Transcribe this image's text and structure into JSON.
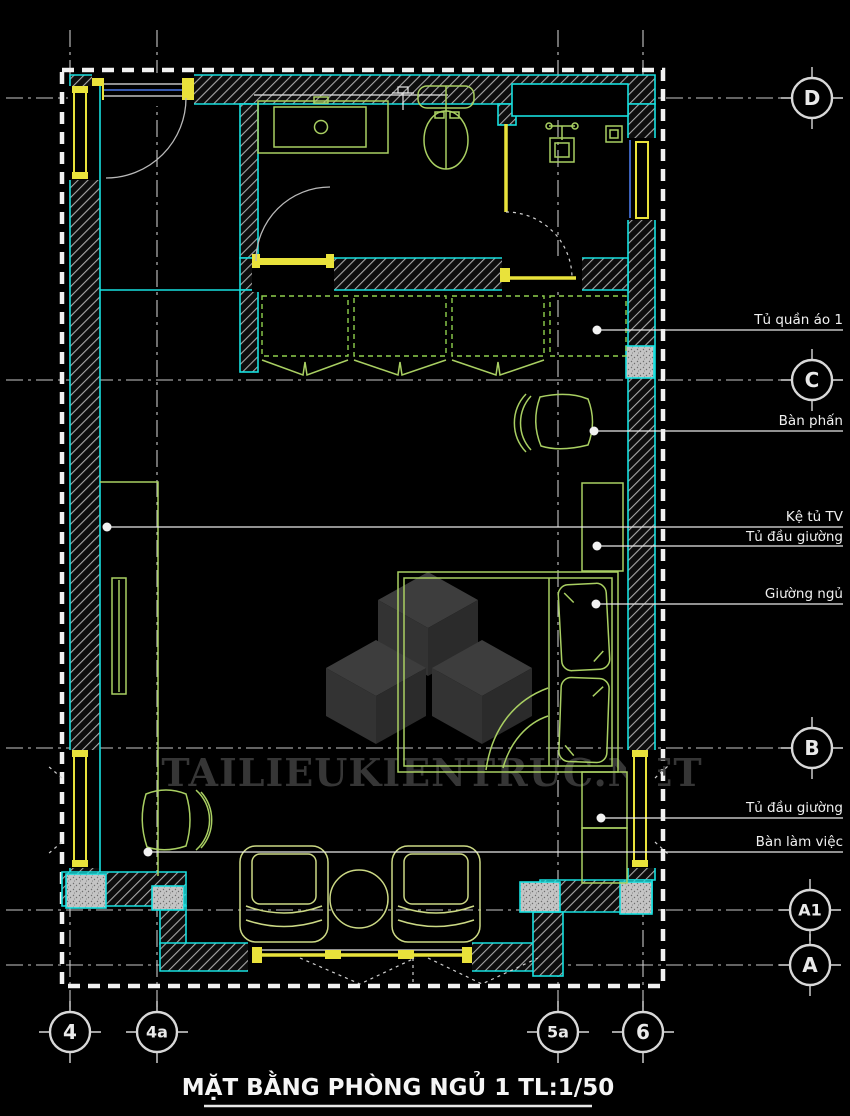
{
  "drawing": {
    "title": "MẶT BẰNG PHÒNG NGỦ 1 TL:1/50",
    "watermark_text": "TAILIEUKIENTRUC.NET"
  },
  "grid": {
    "horizontal_markers": [
      {
        "label": "D"
      },
      {
        "label": "C"
      },
      {
        "label": "B"
      },
      {
        "label": "A1"
      },
      {
        "label": "A"
      }
    ],
    "vertical_markers": [
      {
        "label": "4"
      },
      {
        "label": "4a"
      },
      {
        "label": "5a"
      },
      {
        "label": "6"
      }
    ]
  },
  "annotations": [
    {
      "label": "Tủ quần áo 1"
    },
    {
      "label": "Bàn phấn"
    },
    {
      "label": "Kệ tủ TV"
    },
    {
      "label": "Tủ đầu giường"
    },
    {
      "label": "Giường ngủ"
    },
    {
      "label": "Tủ đầu giường"
    },
    {
      "label": "Bàn làm việc"
    }
  ],
  "colors": {
    "background": "#000000",
    "wall_outline_cyan": "#17dfdf",
    "frame_yellow": "#e9e23b",
    "furniture_green": "#a9cf62",
    "pale_green": "#ccd985",
    "glass_blue": "#4a78e8",
    "annotation_white": "#f0f0f0",
    "watermark_gray": "#3b3b3b"
  }
}
